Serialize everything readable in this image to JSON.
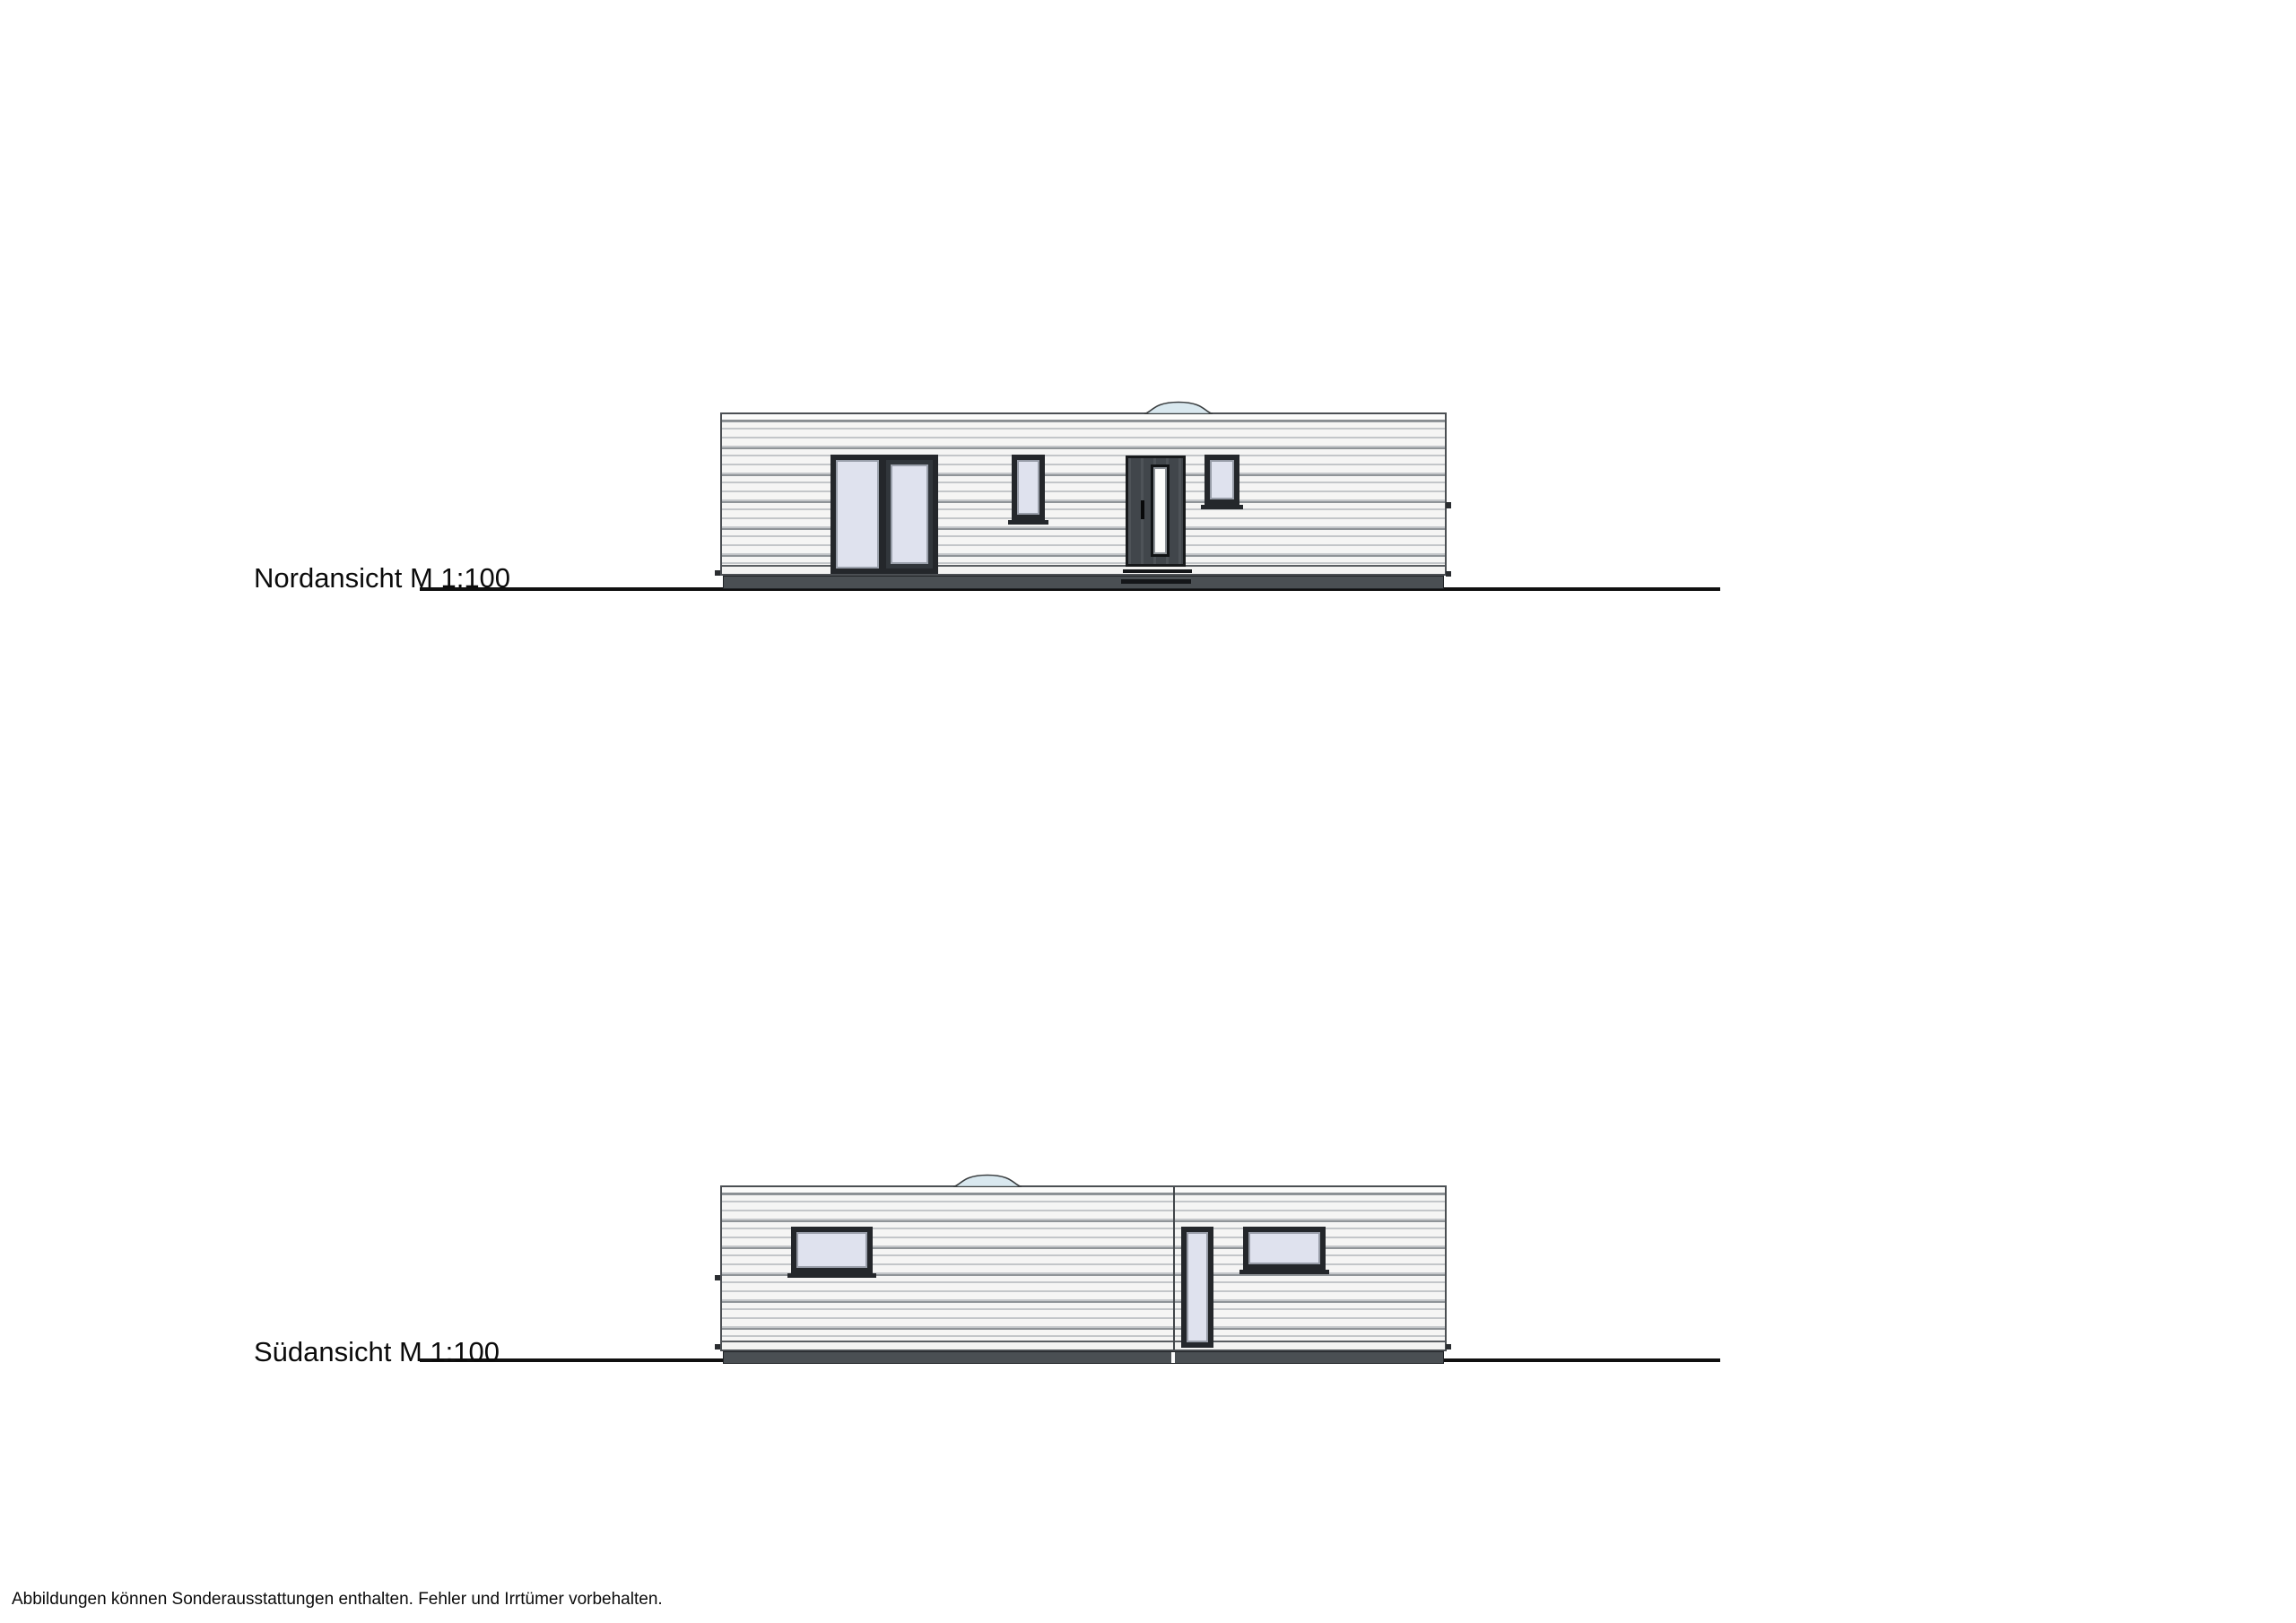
{
  "views": {
    "north": {
      "label": "Nordansicht M 1:100",
      "features": [
        "roof-dome-skylight",
        "patio-glass-door",
        "narrow-window",
        "entrance-door",
        "small-window",
        "plinth",
        "door-step",
        "ground-line"
      ]
    },
    "south": {
      "label": "Südansicht M 1:100",
      "features": [
        "roof-dome-skylight",
        "left-window",
        "module-seam",
        "tall-narrow-window",
        "right-window",
        "plinth",
        "ground-line"
      ]
    }
  },
  "footer": {
    "disclaimer": "Abbildungen können Sonderausstattungen enthalten. Fehler und Irrtümer vorbehalten."
  },
  "colors": {
    "paper": "#ffffff",
    "wall-face": "#f5f5f4",
    "siding-line": "#c3c6c9",
    "siding-line-dark": "#8f9498",
    "outline": "#4b4f53",
    "frame": "#24272b",
    "glass": "#dfe2ee",
    "door-body": "#41464b",
    "door-glass": "#fbfbfa",
    "plinth": "#4a4f53",
    "step": "#141619",
    "dome-fill": "#d9e8ef",
    "dome-stroke": "#3a3e40",
    "ground-line": "#101010",
    "text": "#0b0b0b"
  }
}
